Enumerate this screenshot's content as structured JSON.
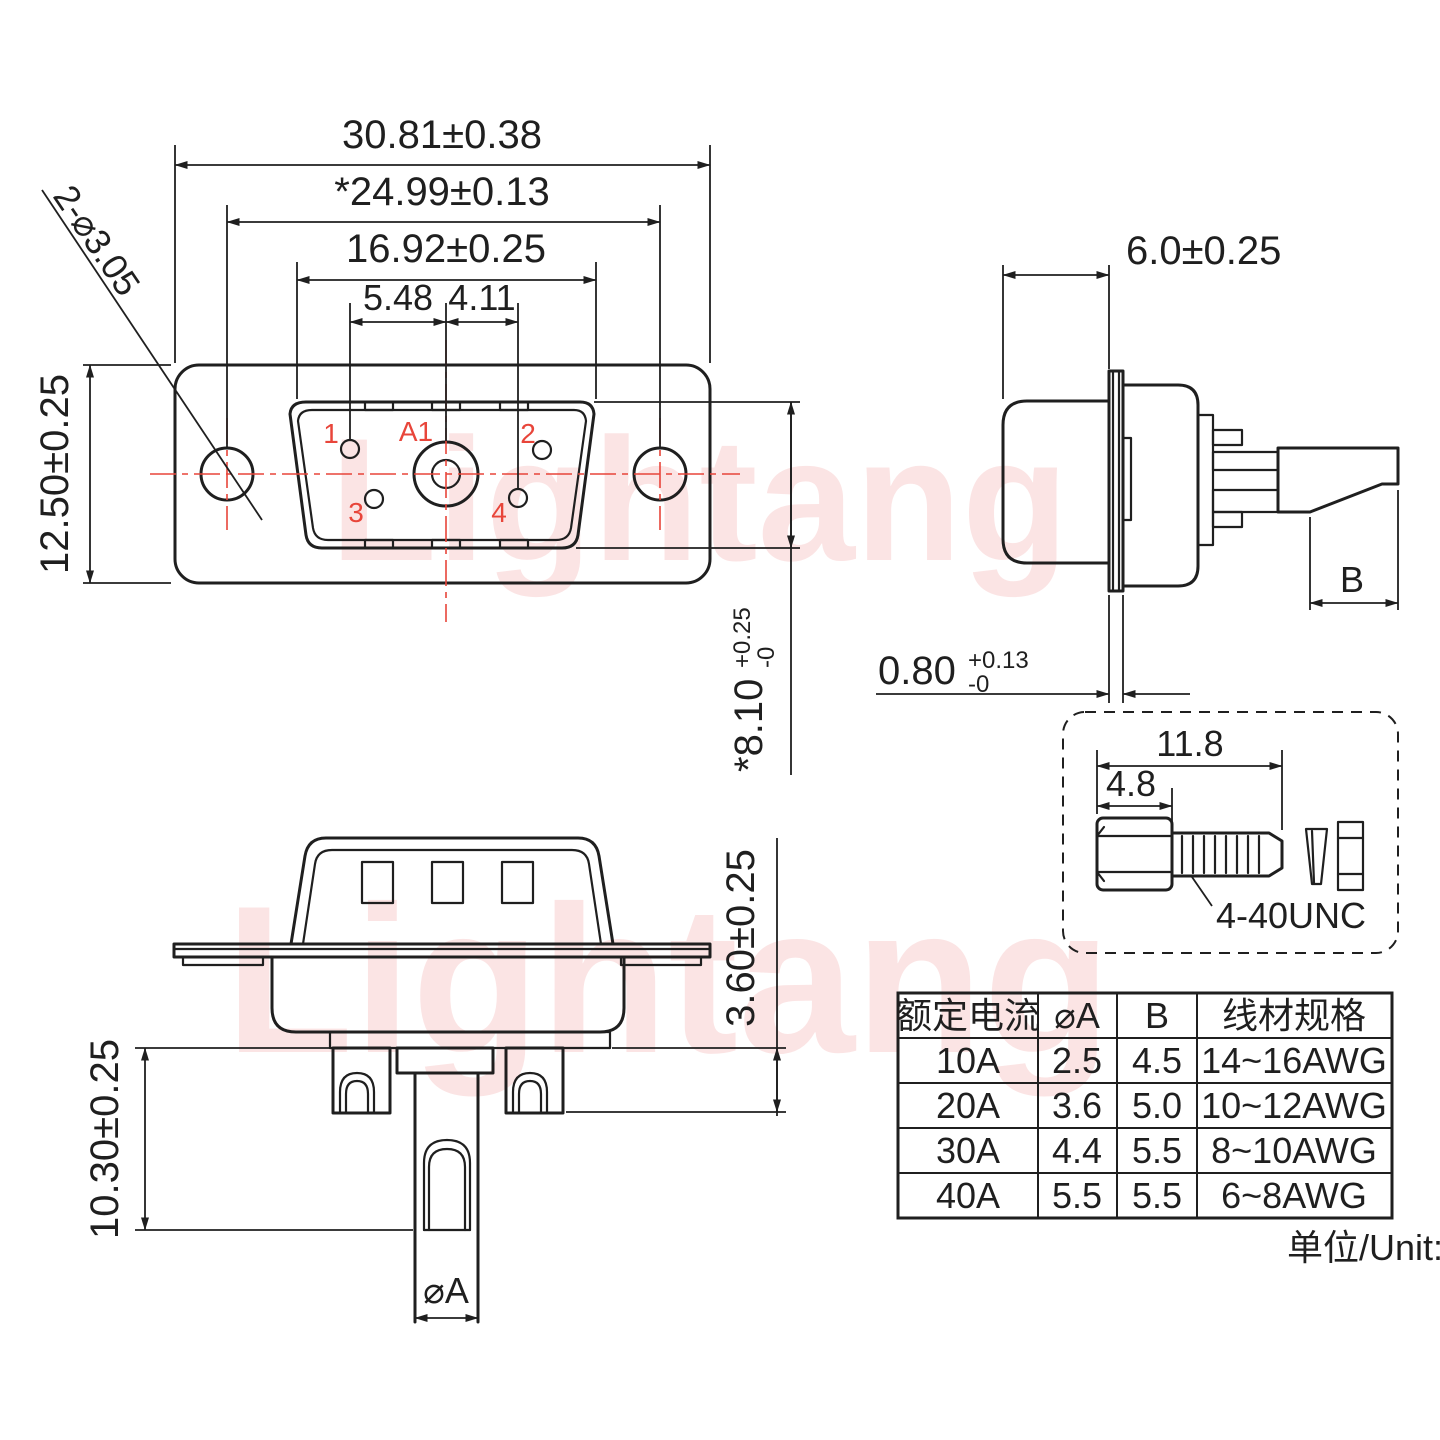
{
  "colors": {
    "line": "#1f1f1f",
    "accent_red": "#e8453a",
    "watermark_pink": "#f8caca",
    "background": "#ffffff"
  },
  "watermark": {
    "text": "Lightang"
  },
  "front_view": {
    "dim_total_width": "30.81±0.38",
    "dim_mount_spacing": "*24.99±0.13",
    "dim_shell_width": "16.92±0.25",
    "dim_pin_left": "5.48",
    "dim_pin_right": "4.11",
    "dim_flange_height": "12.50±0.25",
    "dim_mount_holes": "2-⌀3.05",
    "dim_shell_height": {
      "main": "*8.10",
      "plus": "+0.25",
      "minus": "-0"
    },
    "pin_labels": {
      "p1": "1",
      "p2": "2",
      "p3": "3",
      "p4": "4",
      "a1": "A1"
    }
  },
  "side_view": {
    "dim_body_depth": "6.0±0.25",
    "dim_flange_thickness": {
      "main": "0.80",
      "plus": "+0.13",
      "minus": "-0"
    },
    "dim_wire_strip": "B"
  },
  "bottom_view": {
    "dim_insulator_height": "3.60±0.25",
    "dim_pin_length": "10.30±0.25",
    "dim_pin_diameter": "⌀A"
  },
  "screw_detail": {
    "dim_total_length": "11.8",
    "dim_head_length": "4.8",
    "thread_spec": "4-40UNC"
  },
  "spec_table": {
    "headers": [
      "额定电流",
      "⌀A",
      "B",
      "线材规格"
    ],
    "rows": [
      [
        "10A",
        "2.5",
        "4.5",
        "14~16AWG"
      ],
      [
        "20A",
        "3.6",
        "5.0",
        "10~12AWG"
      ],
      [
        "30A",
        "4.4",
        "5.5",
        "8~10AWG"
      ],
      [
        "40A",
        "5.5",
        "5.5",
        "6~8AWG"
      ]
    ],
    "unit_note": "单位/Unit:mm"
  }
}
